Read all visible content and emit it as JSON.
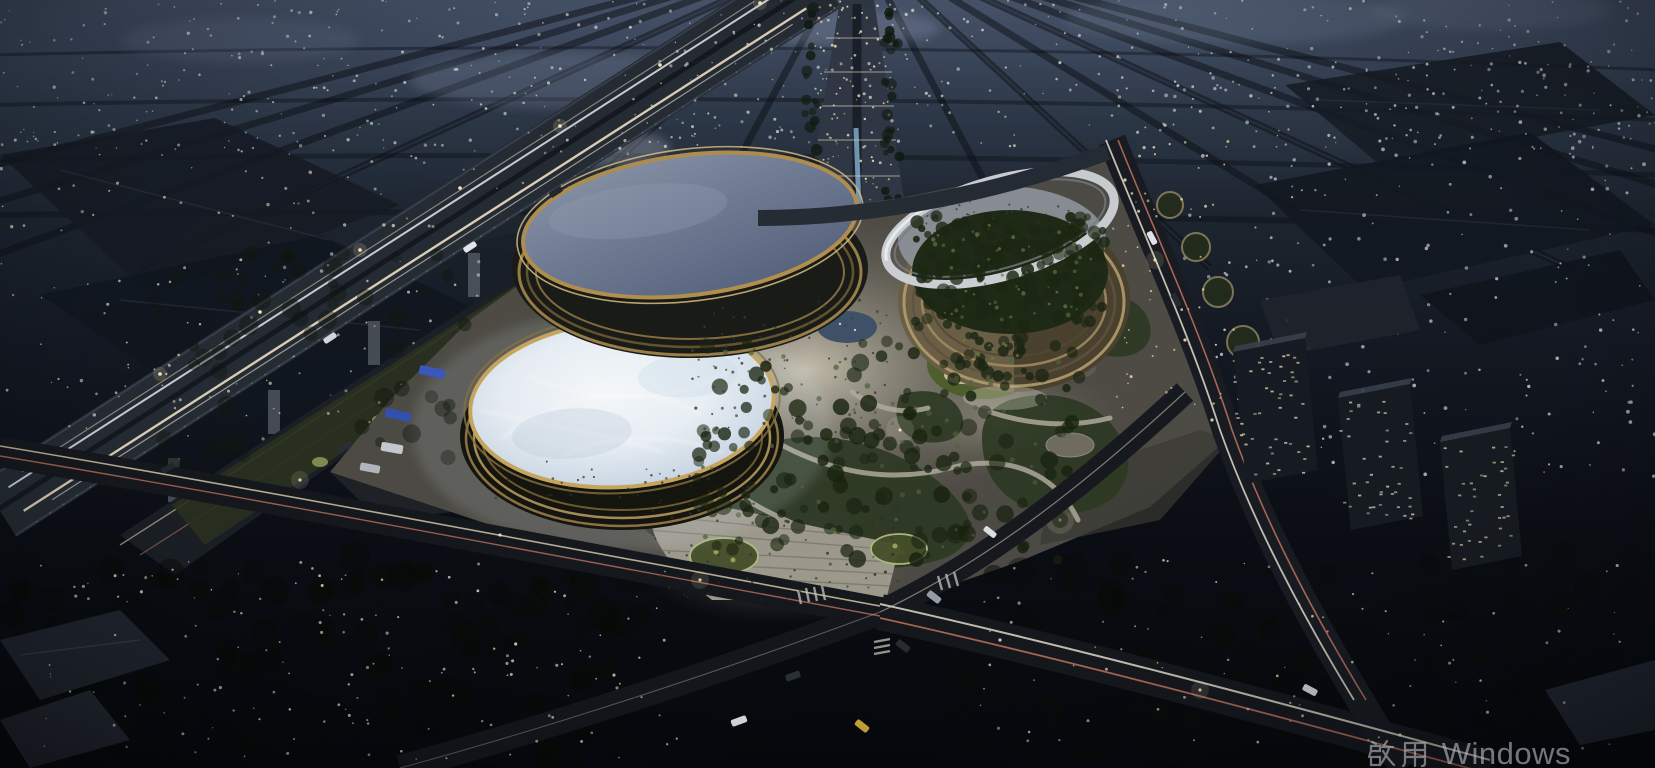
{
  "meta": {
    "scene_type": "architectural-rendering",
    "description": "Night-time aerial rendering of a civic complex: two elliptical glass-roofed arenas and a ring building with a tree-filled courtyard, beside an elevated expressway in a dense city at dusk"
  },
  "watermark": {
    "text": "啟用 Windows",
    "cjk": "啟用",
    "latin": "Windows",
    "color": "#b6bbc1"
  },
  "palette": {
    "sky_horizon": "#49566c",
    "city_shadow": "#10141b",
    "roof_slate_blue": "#7b86a0",
    "roof_ice_white": "#edf3f8",
    "louver_gold": "#b2904e",
    "facade_tan": "#a08d68",
    "ring_silver": "#ccd0d5",
    "courtyard_green": "#1f2a16",
    "park_green": "#2e3a24",
    "plaza_warm_grey": "#cfc9ba",
    "road_asphalt": "#15181d",
    "taillight_red": "#dd8168",
    "headlight_warm": "#f2e5c6",
    "tree_light_warm": "#efe7cd",
    "window_lit": "#d6cba1",
    "bus_blue": "#3b59c0",
    "watermark_grey": "#b6bbc1"
  },
  "scene": {
    "buildings": [
      {
        "name": "north-arena",
        "roof": "slate-blue glass oval with gold louver rim"
      },
      {
        "name": "south-arena",
        "roof": "brightly lit ice-white glass oval"
      },
      {
        "name": "east-ring-building",
        "roof": "open tree courtyard with tilted silver ring"
      }
    ],
    "dotfields": [
      {
        "name": "city-lights-far",
        "layer": "back",
        "x": 0,
        "y": 0,
        "w": 1655,
        "h": 150,
        "n": 520,
        "color": "#dfe3d8",
        "rmin": 0.6,
        "rmax": 1.7,
        "op": 0.8,
        "seed": 11
      },
      {
        "name": "city-lights-mid-left",
        "layer": "back",
        "x": 0,
        "y": 130,
        "w": 480,
        "h": 310,
        "n": 150,
        "color": "#e8e2c8",
        "rmin": 0.7,
        "rmax": 1.8,
        "op": 0.75,
        "seed": 22
      },
      {
        "name": "city-lights-mid-right",
        "layer": "back",
        "x": 1150,
        "y": 60,
        "w": 505,
        "h": 420,
        "n": 260,
        "color": "#e3e6ea",
        "rmin": 0.7,
        "rmax": 1.9,
        "op": 0.75,
        "seed": 33
      },
      {
        "name": "city-lights-center",
        "layer": "back",
        "x": 480,
        "y": 120,
        "w": 420,
        "h": 110,
        "n": 70,
        "color": "#d9dde2",
        "rmin": 0.6,
        "rmax": 1.4,
        "op": 0.6,
        "seed": 44
      },
      {
        "name": "boulevard-lights",
        "layer": "back",
        "x": 816,
        "y": 0,
        "w": 76,
        "h": 215,
        "n": 90,
        "color": "#ffe9bd",
        "rmin": 0.7,
        "rmax": 1.5,
        "op": 0.9,
        "seed": 55
      },
      {
        "name": "boulevard-trees-left",
        "layer": "back",
        "x": 804,
        "y": 0,
        "w": 14,
        "h": 215,
        "n": 26,
        "color": "#101a10",
        "rmin": 3,
        "rmax": 6,
        "op": 0.9,
        "seed": 56
      },
      {
        "name": "boulevard-trees-right",
        "layer": "back",
        "x": 884,
        "y": 0,
        "w": 16,
        "h": 215,
        "n": 26,
        "color": "#101a10",
        "rmin": 3,
        "rmax": 6,
        "op": 0.9,
        "seed": 57
      },
      {
        "name": "west-edge-canopy",
        "layer": "mid",
        "x": 150,
        "y": 250,
        "w": 330,
        "h": 220,
        "n": 60,
        "color": "#11160e",
        "rmin": 5,
        "rmax": 10,
        "op": 0.5,
        "seed": 94
      },
      {
        "name": "park-canopy",
        "layer": "mid",
        "x": 690,
        "y": 340,
        "w": 390,
        "h": 220,
        "n": 150,
        "color": "#19230f",
        "rmin": 4,
        "rmax": 9,
        "op": 0.85,
        "seed": 66
      },
      {
        "name": "park-canopy-lit",
        "layer": "mid",
        "x": 700,
        "y": 350,
        "w": 370,
        "h": 200,
        "n": 60,
        "color": "#54653a",
        "rmin": 1.4,
        "rmax": 3,
        "op": 0.8,
        "seed": 67
      },
      {
        "name": "courtyard-canopy",
        "layer": "mid",
        "x": 915,
        "y": 215,
        "w": 190,
        "h": 112,
        "n": 160,
        "color": "#1c2713",
        "rmin": 3,
        "rmax": 7,
        "op": 0.92,
        "seed": 68
      },
      {
        "name": "courtyard-canopy-lit",
        "layer": "mid",
        "x": 925,
        "y": 225,
        "w": 170,
        "h": 95,
        "n": 55,
        "color": "#5f7040",
        "rmin": 1,
        "rmax": 2.4,
        "op": 0.85,
        "seed": 69
      },
      {
        "name": "lawn-hill-trees",
        "layer": "mid",
        "x": 955,
        "y": 335,
        "w": 70,
        "h": 42,
        "n": 22,
        "color": "#1b2513",
        "rmin": 3,
        "rmax": 6,
        "op": 0.9,
        "seed": 70
      },
      {
        "name": "lawn-hill-trees-lit",
        "layer": "mid",
        "x": 960,
        "y": 340,
        "w": 60,
        "h": 34,
        "n": 10,
        "color": "#6d7d45",
        "rmin": 1,
        "rmax": 2,
        "op": 0.85,
        "seed": 71
      },
      {
        "name": "south-canopy-dark",
        "layer": "mid",
        "x": 0,
        "y": 555,
        "w": 640,
        "h": 210,
        "n": 110,
        "color": "#070b06",
        "rmin": 8,
        "rmax": 16,
        "op": 0.6,
        "seed": 95
      },
      {
        "name": "southeast-canopy-dark",
        "layer": "mid",
        "x": 950,
        "y": 555,
        "w": 700,
        "h": 210,
        "n": 100,
        "color": "#080c08",
        "rmin": 8,
        "rmax": 16,
        "op": 0.55,
        "seed": 96
      },
      {
        "name": "tree-lights-west",
        "layer": "front",
        "x": 40,
        "y": 560,
        "w": 640,
        "h": 200,
        "n": 150,
        "color": "#efe7cd",
        "rmin": 0.6,
        "rmax": 1.6,
        "op": 0.85,
        "seed": 77
      },
      {
        "name": "tree-lights-east",
        "layer": "front",
        "x": 980,
        "y": 560,
        "w": 640,
        "h": 190,
        "n": 85,
        "color": "#e9e2cb",
        "rmin": 0.6,
        "rmax": 1.6,
        "op": 0.8,
        "seed": 78
      },
      {
        "name": "east-avenue-lights",
        "layer": "front",
        "x": 1108,
        "y": 140,
        "w": 130,
        "h": 270,
        "n": 55,
        "color": "#ffe6b0",
        "rmin": 0.7,
        "rmax": 1.5,
        "op": 0.85,
        "seed": 97
      },
      {
        "name": "plaza-crowd",
        "layer": "front",
        "x": 690,
        "y": 300,
        "w": 200,
        "h": 135,
        "n": 90,
        "color": "#3b3a34",
        "rmin": 0.9,
        "rmax": 1.6,
        "op": 0.9,
        "seed": 88
      },
      {
        "name": "promenade-crowd",
        "layer": "front",
        "x": 650,
        "y": 500,
        "w": 250,
        "h": 100,
        "n": 70,
        "color": "#2f2e29",
        "rmin": 0.9,
        "rmax": 1.6,
        "op": 0.9,
        "seed": 89
      },
      {
        "name": "dome-rim-crowd",
        "layer": "front",
        "x": 490,
        "y": 460,
        "w": 265,
        "h": 38,
        "n": 40,
        "color": "#2c2c28",
        "rmin": 0.9,
        "rmax": 1.4,
        "op": 0.9,
        "seed": 90
      },
      {
        "name": "ring-deck-crowd",
        "layer": "front",
        "x": 920,
        "y": 200,
        "w": 160,
        "h": 40,
        "n": 35,
        "color": "#35383c",
        "rmin": 0.8,
        "rmax": 1.3,
        "op": 0.9,
        "seed": 87
      },
      {
        "name": "apartment-a-windows",
        "layer": "front",
        "x": 1233,
        "y": 352,
        "w": 74,
        "h": 122,
        "n": 46,
        "color": "#d6cba1",
        "shape": "rect",
        "dw": 3.2,
        "dh": 1.8,
        "op": 0.9,
        "seed": 91
      },
      {
        "name": "apartment-b-windows",
        "layer": "front",
        "x": 1338,
        "y": 398,
        "w": 74,
        "h": 122,
        "n": 42,
        "color": "#d2cdbb",
        "shape": "rect",
        "dw": 3.2,
        "dh": 1.8,
        "op": 0.85,
        "seed": 92
      },
      {
        "name": "apartment-c-windows",
        "layer": "front",
        "x": 1440,
        "y": 442,
        "w": 72,
        "h": 118,
        "n": 40,
        "color": "#d6cba1",
        "shape": "rect",
        "dw": 3.2,
        "dh": 1.8,
        "op": 0.85,
        "seed": 93
      }
    ],
    "vehicles": [
      {
        "name": "bus",
        "x": 432,
        "y": 372,
        "l": 26,
        "w": 9,
        "rot": 12,
        "color": "#3b59c0"
      },
      {
        "name": "bus",
        "x": 398,
        "y": 415,
        "l": 26,
        "w": 9,
        "rot": 12,
        "color": "#3452b2"
      },
      {
        "name": "truck",
        "x": 392,
        "y": 448,
        "l": 22,
        "w": 9,
        "rot": 10,
        "color": "#c9cdd3"
      },
      {
        "name": "truck",
        "x": 370,
        "y": 468,
        "l": 20,
        "w": 8,
        "rot": 10,
        "color": "#b6bac0"
      },
      {
        "name": "car",
        "x": 739,
        "y": 721,
        "l": 16,
        "w": 7,
        "rot": -20,
        "color": "#e9ebee"
      },
      {
        "name": "car",
        "x": 793,
        "y": 676,
        "l": 15,
        "w": 7,
        "rot": -20,
        "color": "#2c3138"
      },
      {
        "name": "car",
        "x": 934,
        "y": 597,
        "l": 15,
        "w": 7,
        "rot": 38,
        "color": "#9aa0a8"
      },
      {
        "name": "car",
        "x": 903,
        "y": 646,
        "l": 15,
        "w": 7,
        "rot": 38,
        "color": "#272c33"
      },
      {
        "name": "taxi",
        "x": 862,
        "y": 726,
        "l": 15,
        "w": 7,
        "rot": 38,
        "color": "#d8b13b"
      },
      {
        "name": "car",
        "x": 990,
        "y": 532,
        "l": 14,
        "w": 6,
        "rot": 38,
        "color": "#dfe2e6"
      },
      {
        "name": "car",
        "x": 470,
        "y": 247,
        "l": 14,
        "w": 6,
        "rot": -33,
        "color": "#e6e9ee"
      },
      {
        "name": "car",
        "x": 330,
        "y": 338,
        "l": 14,
        "w": 6,
        "rot": -33,
        "color": "#d8dbe0"
      },
      {
        "name": "car",
        "x": 556,
        "y": 192,
        "l": 14,
        "w": 6,
        "rot": -33,
        "color": "#23272e"
      },
      {
        "name": "car",
        "x": 168,
        "y": 468,
        "l": 14,
        "w": 6,
        "rot": -28,
        "color": "#23272e"
      },
      {
        "name": "car",
        "x": 345,
        "y": 447,
        "l": 14,
        "w": 6,
        "rot": -28,
        "color": "#2a2f36"
      },
      {
        "name": "car",
        "x": 1152,
        "y": 238,
        "l": 14,
        "w": 6,
        "rot": 62,
        "color": "#e4e7eb"
      },
      {
        "name": "car",
        "x": 1176,
        "y": 300,
        "l": 14,
        "w": 6,
        "rot": 62,
        "color": "#262b32"
      },
      {
        "name": "car",
        "x": 1310,
        "y": 690,
        "l": 15,
        "w": 7,
        "rot": 28,
        "color": "#d4d7db"
      }
    ]
  }
}
